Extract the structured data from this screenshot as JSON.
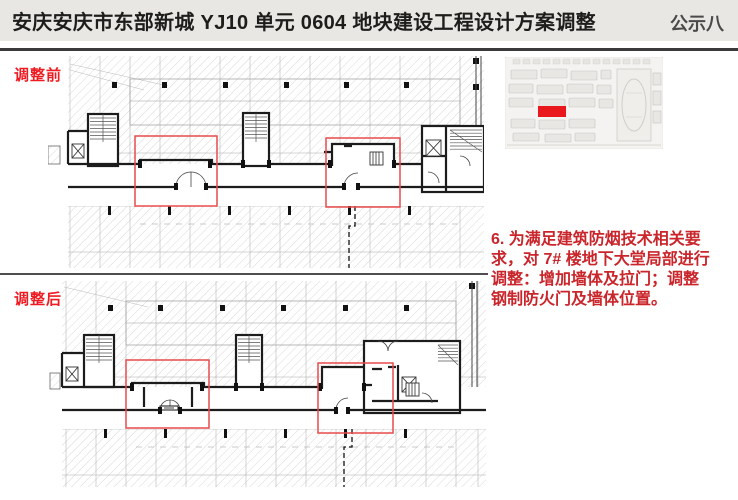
{
  "header": {
    "title": "安庆安庆市东部新城 YJ10 单元 0604 地块建设工程设计方案调整",
    "page_label": "公示八"
  },
  "plans": {
    "before_label": "调整前",
    "after_label": "调整后"
  },
  "note": {
    "text": "6. 为满足建筑防烟技术相关要求，对 7# 楼地下大堂局部进行调整：增加墙体及拉门；调整钢制防火门及墙体位置。",
    "lines": [
      "6. 为满足建筑防烟技术相关要",
      "求，对 7# 楼地下大堂局部进行",
      "调整：增加墙体及拉门；调整",
      "钢制防火门及墙体位置。"
    ]
  },
  "colors": {
    "header_bg": "#e9e7e3",
    "header_text": "#1d1d1b",
    "page_label_text": "#4a4a4a",
    "label_red": "#ee1c22",
    "note_red": "#c9252b",
    "highlight_box_red": "#e94a4a",
    "site_highlight_red": "#e8181d",
    "divider_gray": "#4f4f4f"
  }
}
